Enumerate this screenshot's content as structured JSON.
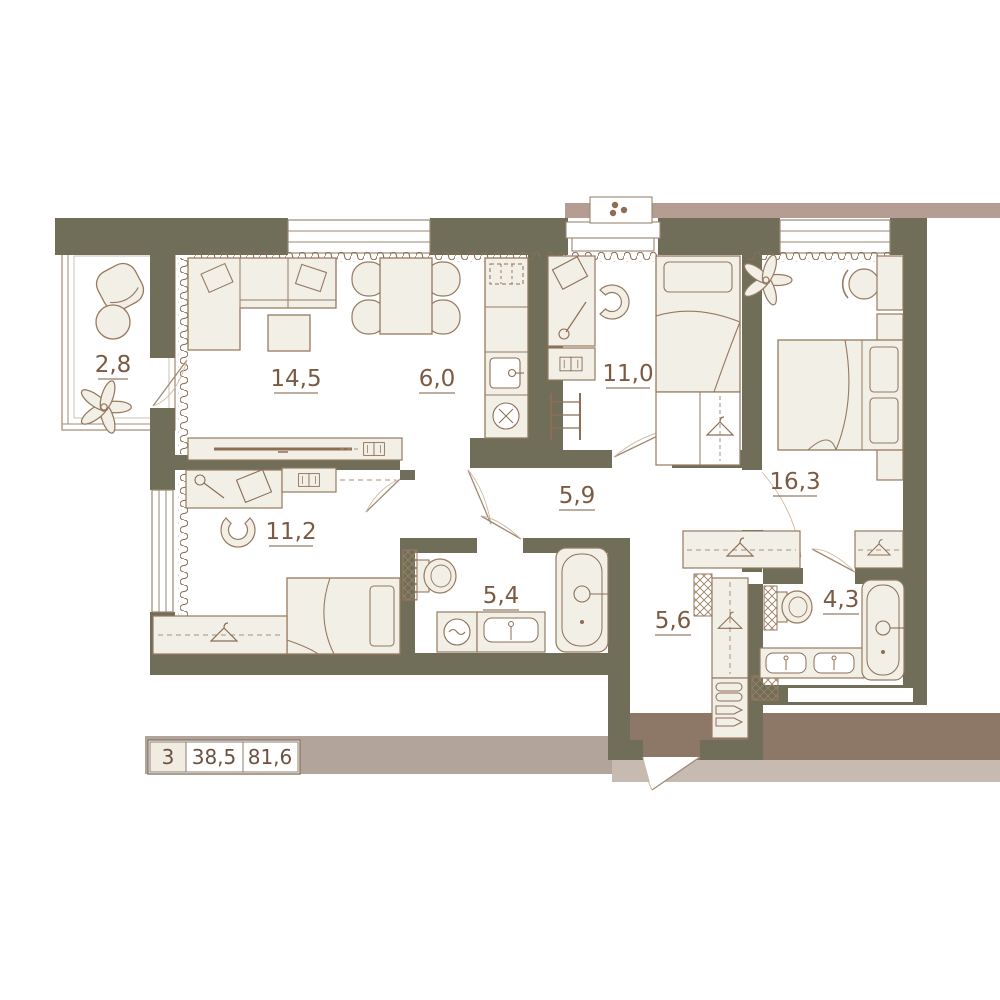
{
  "legend": {
    "rooms_count": "3",
    "living_area": "38,5",
    "total_area": "81,6"
  },
  "rooms": {
    "balcony": {
      "area": "2,8"
    },
    "living": {
      "area": "14,5"
    },
    "kitchen": {
      "area": "6,0"
    },
    "bedroom_1": {
      "area": "11,0"
    },
    "master_bedroom": {
      "area": "16,3"
    },
    "bedroom_2": {
      "area": "11,2"
    },
    "hallway": {
      "area": "5,9"
    },
    "bathroom": {
      "area": "5,4"
    },
    "entry_hall": {
      "area": "5,6"
    },
    "bathroom_2": {
      "area": "4,3"
    }
  },
  "colors": {
    "wall": "#706e58",
    "furniture_fill": "#f2efe7",
    "furniture_line": "#97795f",
    "detail_line": "#8d6e55",
    "label_text": "#7b5a41",
    "band_pink": "#b59d93",
    "band_dark_brown": "#8d7868",
    "band_beige": "#c6bab1",
    "legend_strip": "#b2a49b"
  }
}
